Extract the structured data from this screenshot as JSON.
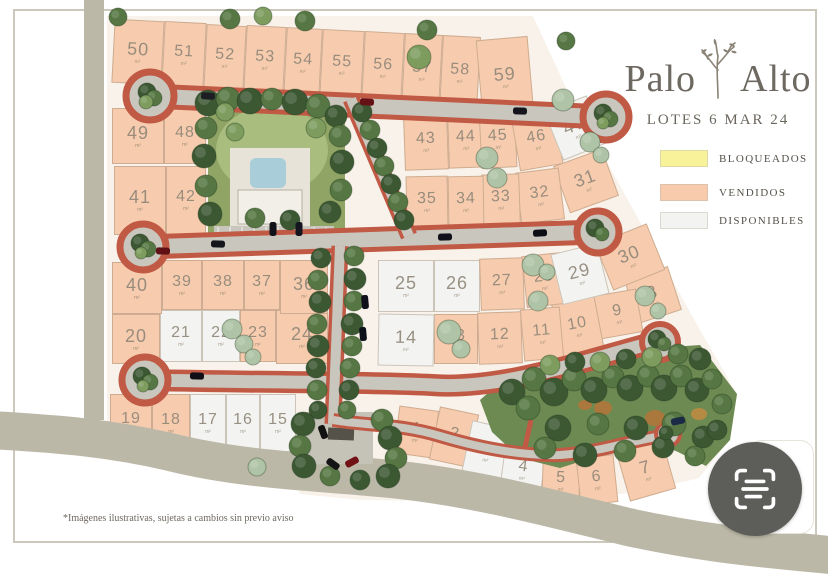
{
  "header": {
    "brand_word1": "Palo",
    "brand_word2": "Alto",
    "subtitle": "LOTES 6 MAR 24"
  },
  "legend": {
    "items": [
      {
        "label": "BLOQUEADOS",
        "key": "bloqueados",
        "color": "#f8f29b"
      },
      {
        "label": "VENDIDOS",
        "key": "vendidos",
        "color": "#f7cbac"
      },
      {
        "label": "DISPONIBLES",
        "key": "disponibles",
        "color": "#f3f4f1"
      }
    ]
  },
  "footer": {
    "disclaimer": "*Imágenes ilustrativas, sujetas a cambios sin previo aviso"
  },
  "map": {
    "area_unit": "m²",
    "status_colors": {
      "bloqueados": "#f8f29b",
      "vendidos": "#f7ccae",
      "disponibles": "#f3f4f1"
    },
    "road_edge_color": "#c05a45",
    "road_fill_color": "#c9c6be",
    "lots": [
      {
        "n": "1",
        "x": 396,
        "y": 408,
        "w": 40,
        "h": 48,
        "r": 8,
        "status": "vendidos"
      },
      {
        "n": "2",
        "x": 434,
        "y": 410,
        "w": 40,
        "h": 54,
        "r": 12,
        "status": "vendidos"
      },
      {
        "n": "3",
        "x": 466,
        "y": 424,
        "w": 42,
        "h": 56,
        "r": 12,
        "status": "disponibles"
      },
      {
        "n": "4",
        "x": 502,
        "y": 442,
        "w": 42,
        "h": 56,
        "r": 8,
        "status": "disponibles"
      },
      {
        "n": "5",
        "x": 542,
        "y": 456,
        "w": 38,
        "h": 50,
        "r": 2,
        "status": "vendidos"
      },
      {
        "n": "6",
        "x": 578,
        "y": 456,
        "w": 38,
        "h": 48,
        "r": -6,
        "status": "vendidos"
      },
      {
        "n": "7",
        "x": 622,
        "y": 444,
        "w": 48,
        "h": 52,
        "r": -16,
        "status": "vendidos"
      },
      {
        "n": "8",
        "x": 630,
        "y": 272,
        "w": 46,
        "h": 46,
        "r": -18,
        "status": "vendidos"
      },
      {
        "n": "9",
        "x": 596,
        "y": 292,
        "w": 44,
        "h": 44,
        "r": -10,
        "status": "vendidos"
      },
      {
        "n": "10",
        "x": 556,
        "y": 300,
        "w": 44,
        "h": 54,
        "r": -11,
        "status": "vendidos"
      },
      {
        "n": "11",
        "x": 522,
        "y": 308,
        "w": 40,
        "h": 52,
        "r": -5,
        "status": "vendidos"
      },
      {
        "n": "12",
        "x": 478,
        "y": 312,
        "w": 44,
        "h": 52,
        "r": -2,
        "status": "vendidos"
      },
      {
        "n": "13",
        "x": 434,
        "y": 314,
        "w": 44,
        "h": 50,
        "r": 0,
        "status": "vendidos"
      },
      {
        "n": "14",
        "x": 378,
        "y": 314,
        "w": 56,
        "h": 52,
        "r": 1,
        "status": "disponibles"
      },
      {
        "n": "15",
        "x": 260,
        "y": 394,
        "w": 36,
        "h": 58,
        "r": 0,
        "status": "disponibles"
      },
      {
        "n": "16",
        "x": 226,
        "y": 394,
        "w": 34,
        "h": 58,
        "r": 0,
        "status": "disponibles"
      },
      {
        "n": "17",
        "x": 190,
        "y": 394,
        "w": 36,
        "h": 58,
        "r": 0,
        "status": "disponibles"
      },
      {
        "n": "18",
        "x": 152,
        "y": 394,
        "w": 38,
        "h": 58,
        "r": 0,
        "status": "vendidos"
      },
      {
        "n": "19",
        "x": 110,
        "y": 394,
        "w": 42,
        "h": 56,
        "r": 0,
        "status": "vendidos"
      },
      {
        "n": "20",
        "x": 112,
        "y": 314,
        "w": 48,
        "h": 50,
        "r": 0,
        "status": "vendidos"
      },
      {
        "n": "21",
        "x": 160,
        "y": 310,
        "w": 42,
        "h": 52,
        "r": 0,
        "status": "disponibles"
      },
      {
        "n": "22",
        "x": 202,
        "y": 310,
        "w": 38,
        "h": 52,
        "r": 0,
        "status": "disponibles"
      },
      {
        "n": "23",
        "x": 240,
        "y": 310,
        "w": 36,
        "h": 52,
        "r": 0,
        "status": "vendidos"
      },
      {
        "n": "24",
        "x": 276,
        "y": 310,
        "w": 52,
        "h": 54,
        "r": 0,
        "status": "vendidos"
      },
      {
        "n": "25",
        "x": 378,
        "y": 260,
        "w": 56,
        "h": 52,
        "r": 0,
        "status": "disponibles"
      },
      {
        "n": "26",
        "x": 434,
        "y": 260,
        "w": 46,
        "h": 52,
        "r": 0,
        "status": "disponibles"
      },
      {
        "n": "27",
        "x": 480,
        "y": 258,
        "w": 44,
        "h": 52,
        "r": -2,
        "status": "vendidos"
      },
      {
        "n": "28",
        "x": 524,
        "y": 254,
        "w": 40,
        "h": 52,
        "r": -6,
        "status": "vendidos"
      },
      {
        "n": "29",
        "x": 556,
        "y": 248,
        "w": 48,
        "h": 52,
        "r": -14,
        "status": "disponibles"
      },
      {
        "n": "30",
        "x": 602,
        "y": 232,
        "w": 56,
        "h": 50,
        "r": -22,
        "status": "vendidos"
      },
      {
        "n": "31",
        "x": 560,
        "y": 156,
        "w": 52,
        "h": 50,
        "r": -20,
        "status": "vendidos"
      },
      {
        "n": "32",
        "x": 518,
        "y": 170,
        "w": 44,
        "h": 52,
        "r": -7,
        "status": "vendidos"
      },
      {
        "n": "33",
        "x": 482,
        "y": 174,
        "w": 38,
        "h": 52,
        "r": -2,
        "status": "vendidos"
      },
      {
        "n": "34",
        "x": 448,
        "y": 176,
        "w": 36,
        "h": 52,
        "r": -1,
        "status": "vendidos"
      },
      {
        "n": "35",
        "x": 406,
        "y": 176,
        "w": 42,
        "h": 52,
        "r": -1,
        "status": "vendidos"
      },
      {
        "n": "36",
        "x": 280,
        "y": 260,
        "w": 48,
        "h": 54,
        "r": 0,
        "status": "vendidos"
      },
      {
        "n": "37",
        "x": 244,
        "y": 260,
        "w": 36,
        "h": 50,
        "r": 0,
        "status": "vendidos"
      },
      {
        "n": "38",
        "x": 202,
        "y": 260,
        "w": 42,
        "h": 50,
        "r": 0,
        "status": "vendidos"
      },
      {
        "n": "39",
        "x": 162,
        "y": 260,
        "w": 40,
        "h": 50,
        "r": 0,
        "status": "vendidos"
      },
      {
        "n": "40",
        "x": 112,
        "y": 262,
        "w": 50,
        "h": 52,
        "r": 0,
        "status": "vendidos"
      },
      {
        "n": "41",
        "x": 114,
        "y": 166,
        "w": 52,
        "h": 69,
        "r": 0,
        "status": "vendidos"
      },
      {
        "n": "42",
        "x": 166,
        "y": 166,
        "w": 40,
        "h": 69,
        "r": 0,
        "status": "vendidos"
      },
      {
        "n": "43",
        "x": 404,
        "y": 114,
        "w": 44,
        "h": 56,
        "r": -2,
        "status": "vendidos"
      },
      {
        "n": "44",
        "x": 448,
        "y": 112,
        "w": 36,
        "h": 56,
        "r": -2,
        "status": "vendidos"
      },
      {
        "n": "45",
        "x": 480,
        "y": 110,
        "w": 36,
        "h": 58,
        "r": -3,
        "status": "vendidos"
      },
      {
        "n": "46",
        "x": 515,
        "y": 112,
        "w": 44,
        "h": 56,
        "r": -10,
        "status": "vendidos"
      },
      {
        "n": "47",
        "x": 552,
        "y": 102,
        "w": 46,
        "h": 52,
        "r": -22,
        "status": "disponibles"
      },
      {
        "n": "48",
        "x": 164,
        "y": 108,
        "w": 42,
        "h": 56,
        "r": 0,
        "status": "vendidos"
      },
      {
        "n": "49",
        "x": 112,
        "y": 108,
        "w": 52,
        "h": 56,
        "r": 0,
        "status": "vendidos"
      },
      {
        "n": "50",
        "x": 113,
        "y": 20,
        "w": 50,
        "h": 64,
        "r": 3,
        "status": "vendidos"
      },
      {
        "n": "51",
        "x": 163,
        "y": 22,
        "w": 42,
        "h": 66,
        "r": 3,
        "status": "vendidos"
      },
      {
        "n": "52",
        "x": 205,
        "y": 25,
        "w": 40,
        "h": 66,
        "r": 3,
        "status": "vendidos"
      },
      {
        "n": "53",
        "x": 245,
        "y": 26,
        "w": 40,
        "h": 68,
        "r": 3,
        "status": "vendidos"
      },
      {
        "n": "54",
        "x": 285,
        "y": 28,
        "w": 36,
        "h": 70,
        "r": 3,
        "status": "vendidos"
      },
      {
        "n": "55",
        "x": 321,
        "y": 30,
        "w": 42,
        "h": 70,
        "r": 3,
        "status": "vendidos"
      },
      {
        "n": "56",
        "x": 363,
        "y": 32,
        "w": 40,
        "h": 72,
        "r": 3,
        "status": "vendidos"
      },
      {
        "n": "57",
        "x": 403,
        "y": 34,
        "w": 38,
        "h": 74,
        "r": 3,
        "status": "vendidos"
      },
      {
        "n": "58",
        "x": 441,
        "y": 36,
        "w": 38,
        "h": 74,
        "r": 3,
        "status": "vendidos"
      },
      {
        "n": "59",
        "x": 479,
        "y": 38,
        "w": 52,
        "h": 78,
        "r": -5,
        "status": "vendidos"
      }
    ]
  }
}
